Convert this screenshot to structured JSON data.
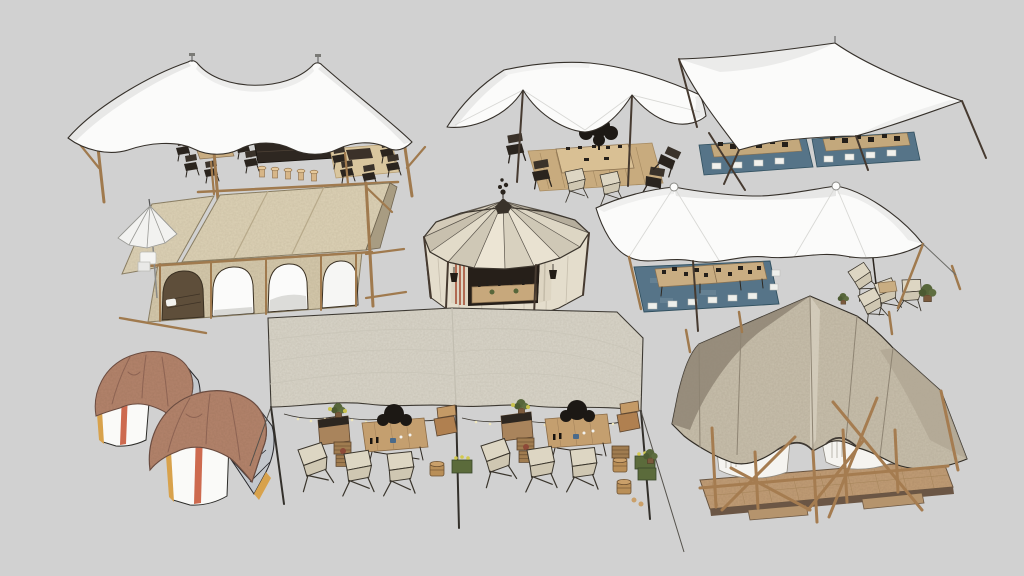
{
  "scene": {
    "description": "3D model render of nine event and glamping tents arranged on a plain gray background",
    "background": "#d1d1d1",
    "items": [
      {
        "id": "stretch-tent-bar",
        "position": "top-left",
        "label": "White stretch tent with bar counter, stools and dining sets"
      },
      {
        "id": "stretch-tent-dining",
        "position": "top-center",
        "label": "White stretch tent with outdoor dining table and folding chairs"
      },
      {
        "id": "stretch-tent-picnic",
        "position": "top-right",
        "label": "White stretch tent over two low picnic tables on teal rugs"
      },
      {
        "id": "canvas-pavilion",
        "position": "middle-left",
        "label": "Beige canvas pavilion with arched openings and white parasol"
      },
      {
        "id": "round-canvas-tent",
        "position": "middle-center",
        "label": "Round segmented canvas tent with bar counter and lanterns"
      },
      {
        "id": "stretch-tent-banquet",
        "position": "middle-right",
        "label": "White stretch tent with banquet tables on rug and lounge chairs"
      },
      {
        "id": "pod-tents",
        "position": "bottom-left",
        "label": "Two terracotta-draped pod tents with striped white fronts"
      },
      {
        "id": "flat-canopy-picnic",
        "position": "bottom-center",
        "label": "Flat canvas canopy with picnic furniture, crates and string lights"
      },
      {
        "id": "safari-lodge-tent",
        "position": "bottom-right",
        "label": "Safari lodge tent with timber frame, white beds and wooden deck"
      }
    ]
  },
  "palette": {
    "background": "#d1d1d1",
    "white_canvas": "#fbfbfa",
    "canvas_shade": "#e8e8e7",
    "outline": "#35302a",
    "wood": "#a07a4e",
    "wood_dark": "#6b5033",
    "beige_canvas": "#ddd2b6",
    "beige_wall": "#d5c9ac",
    "gable_shade": "#a89c82",
    "circus_cream": "#ece5d4",
    "circus_tan": "#cfc7b5",
    "circus_back": "#b2aa99",
    "rug_teal": "#567488",
    "table_tan": "#c9ad82",
    "dark_furniture": "#241f1a",
    "cream_fabric": "#ded7c4",
    "terracotta": "#b4846c",
    "terracotta_shade": "#8d6353",
    "amber_trim": "#d8a24c",
    "stripe_red": "#cd6a4f",
    "tarp_cream": "#d9d5c9",
    "safari_canvas": "#c8bfac",
    "safari_shade": "#8f8574",
    "deck_wood": "#c19d76",
    "greenery": "#57663a",
    "bedding_white": "#f5f4f0"
  }
}
